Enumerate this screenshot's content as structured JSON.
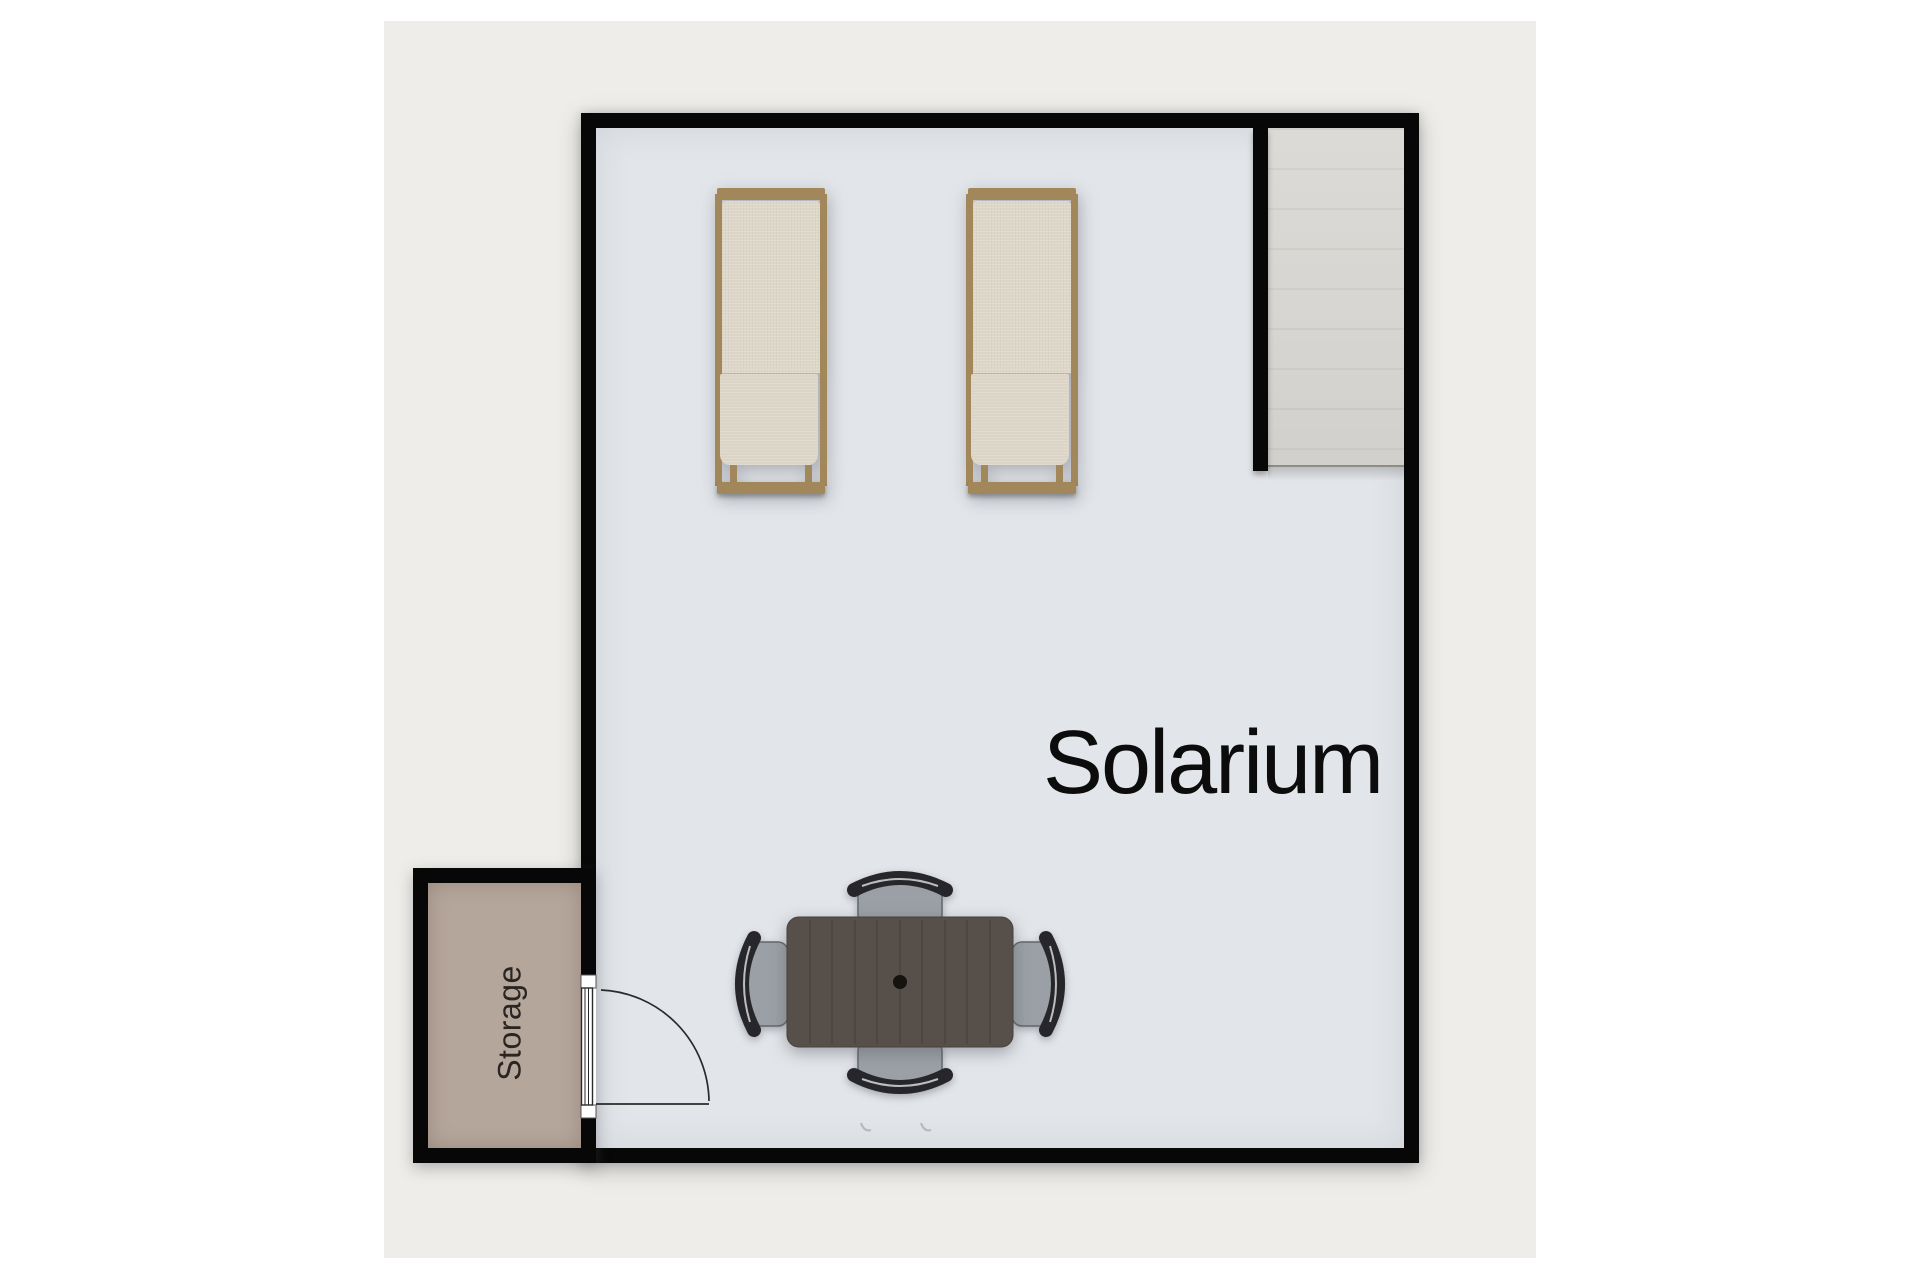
{
  "plan": {
    "title": "Solarium floor plan",
    "rooms": [
      {
        "id": "solarium",
        "label": "Solarium"
      },
      {
        "id": "storage",
        "label": "Storage"
      }
    ],
    "features": [
      "stair-landing",
      "single-swing-door"
    ],
    "furniture": [
      "sun-lounger",
      "sun-lounger",
      "dining-table",
      "dining-chair",
      "dining-chair",
      "dining-chair",
      "dining-chair"
    ]
  },
  "colors": {
    "page-bg": "#ffffff",
    "panel-bg": "#eeede9",
    "wall": "#070707",
    "floor-main": "#e2e5e9",
    "floor-storage": "#b5a69b",
    "floor-stairs": "#d7d5d1",
    "wood": "#a1875a",
    "cushion": "#ded6c9",
    "cushion-2": "#dcd4c6",
    "table": "#57504a",
    "table-line": "#47413c",
    "table-dot": "#16120e",
    "seat": "#9aa0a5",
    "seat-edge": "#62676b",
    "chair-dark": "#27272b",
    "piping": "#e2e4e5",
    "label": "#0c0c0c",
    "storage-label": "#2a2522",
    "door-line": "#2a2a2a"
  }
}
